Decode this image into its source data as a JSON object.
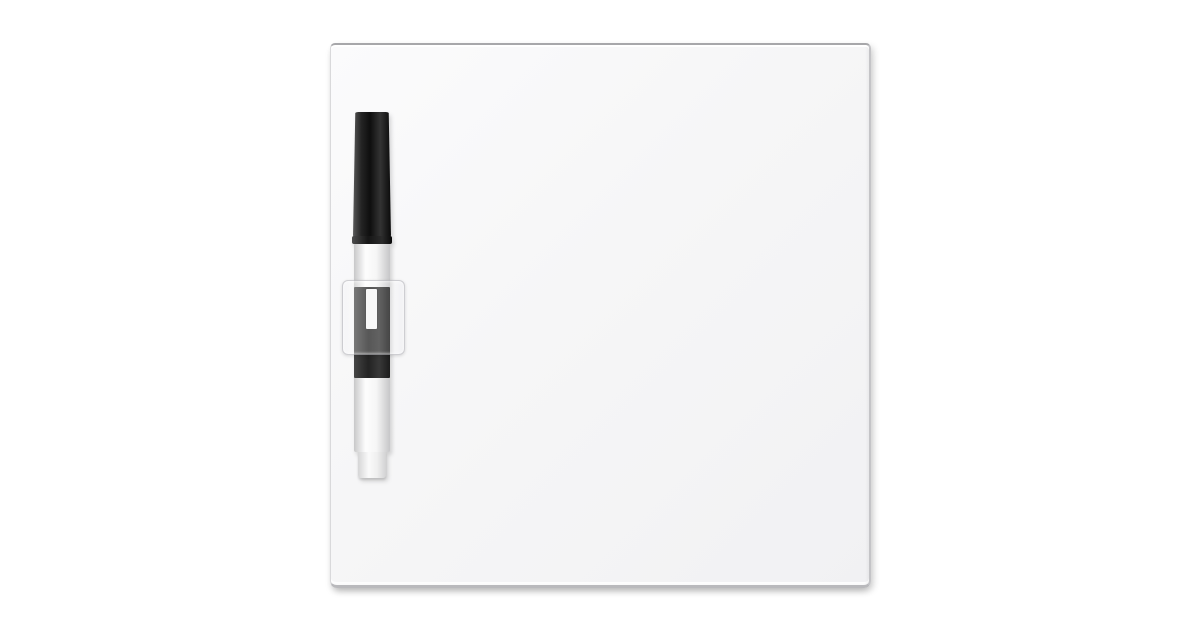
{
  "photo": {
    "background": "#ffffff"
  },
  "board": {
    "surface_color": "#f6f6f7",
    "line_color": "#2e2e2e",
    "first_round_label": "First Round",
    "round_labels": [
      "Second\nRound",
      "Third\nRound",
      "Regional\nSemifinals",
      "Regional\nFinals",
      "National\nSemifinals",
      "NATIONAL\nCHAMPIONSHIP",
      "National\nSemifinals",
      "Regional\nFinals",
      "Regional\nSemifinals",
      "Third\nRound",
      "Second\nRound"
    ],
    "regions": [
      "MIDWEST",
      "EAST",
      "WEST",
      "SOUTH"
    ],
    "seed_order": [
      1,
      16,
      8,
      9,
      5,
      12,
      4,
      13,
      6,
      11,
      3,
      14,
      7,
      10,
      2,
      15
    ],
    "basketball": {
      "primary": "#d2692d",
      "dark": "#a84812",
      "deep_edge": "#8f3a0c",
      "highlight": "#eda266",
      "seam": "#3b200e"
    }
  },
  "pen": {
    "brand": "MARKERBOARD PEOPLE",
    "brand_word_1": "MARKERBOARD",
    "brand_word_2": "PEOPLE",
    "feature": "Ultra Low Odor",
    "type": "MARKER",
    "cap_color": "#1a1a1a",
    "body_color": "#f4f4f4"
  }
}
